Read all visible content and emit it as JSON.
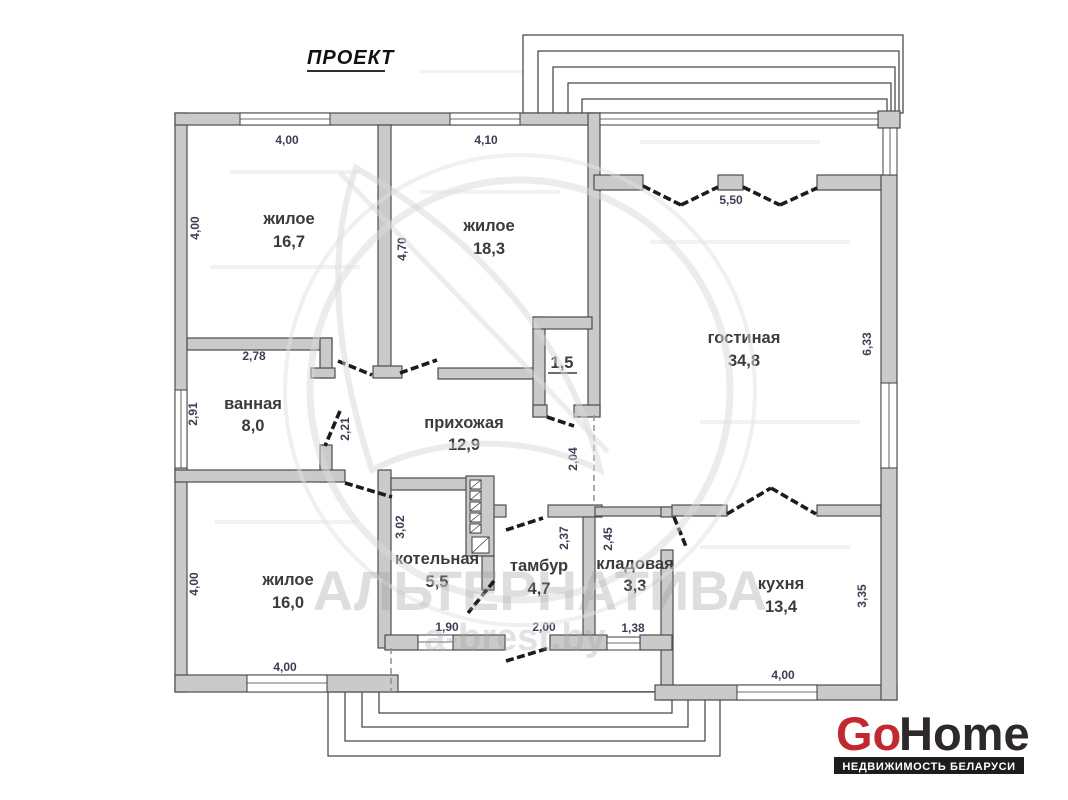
{
  "title": "ПРОЕКТ",
  "rooms": [
    {
      "name": "жилое",
      "area": "16,7"
    },
    {
      "name": "жилое",
      "area": "18,3"
    },
    {
      "name": "гостиная",
      "area": "34,8"
    },
    {
      "name": "ванная",
      "area": "8,0"
    },
    {
      "name": "прихожая",
      "area": "12,9"
    },
    {
      "area": "1,5"
    },
    {
      "name": "жилое",
      "area": "16,0"
    },
    {
      "name": "котельная",
      "area": "5,5"
    },
    {
      "name": "тамбур",
      "area": "4,7"
    },
    {
      "name": "кладовая",
      "area": "3,3"
    },
    {
      "name": "кухня",
      "area": "13,4"
    }
  ],
  "dims": [
    "4,00",
    "4,10",
    "5,50",
    "4,00",
    "4,70",
    "6,33",
    "2,78",
    "2,91",
    "2,21",
    "2,04",
    "3,02",
    "2,37",
    "2,45",
    "3,35",
    "1,90",
    "2,00",
    "1,38",
    "4,00",
    "4,00",
    "4,00"
  ],
  "watermark": {
    "brand": "АЛЬТЕРНАТИВА",
    "site": "a-brest.by"
  },
  "logo": {
    "go": "Go",
    "home": "Home",
    "tagline": "НЕДВИЖИМОСТЬ БЕЛАРУСИ"
  },
  "colors": {
    "logo_red": "#c4272e",
    "logo_dark": "#2d282a",
    "wall": "#cacaca",
    "dim_text": "#3d3d56",
    "room_text": "#3b3b3b"
  }
}
